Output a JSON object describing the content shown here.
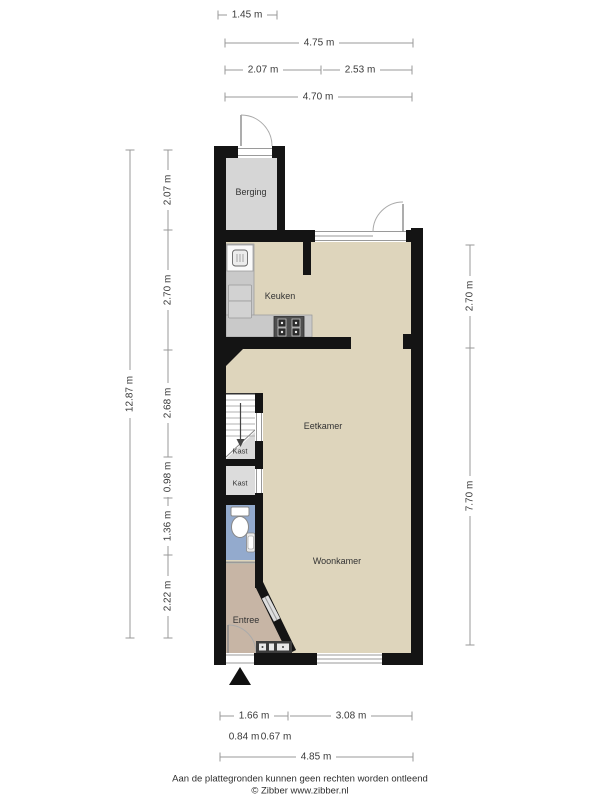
{
  "rooms": {
    "berging": "Berging",
    "keuken": "Keuken",
    "eetkamer": "Eetkamer",
    "kast_understairs": "Kast",
    "kast": "Kast",
    "woonkamer": "Woonkamer",
    "entree": "Entree"
  },
  "dimensions": {
    "top": [
      "1.45 m",
      "4.75 m",
      "2.07 m",
      "2.53 m",
      "4.70 m"
    ],
    "left_total": "12.87 m",
    "left_segments": [
      "2.07 m",
      "2.70 m",
      "2.68 m",
      "0.98 m",
      "1.36 m",
      "2.22 m"
    ],
    "right": [
      "2.70 m",
      "7.70 m"
    ],
    "bottom_row1": [
      "1.66 m",
      "3.08 m"
    ],
    "bottom_row2": [
      "0.84 m",
      "0.67 m"
    ],
    "bottom_total": "4.85 m"
  },
  "footer": {
    "disclaimer": "Aan de plattegronden kunnen geen rechten worden ontleend",
    "credit": "© Zibber www.zibber.nl"
  },
  "colors": {
    "wall": "#141414",
    "floor_main": "#ded5bc",
    "floor_berging": "#d6d6d6",
    "floor_kast": "#dcdcdc",
    "floor_toilet": "#93aacd",
    "floor_entree": "#c7b5a5",
    "counter": "#c9c9c9",
    "stove": "#4f4f4f",
    "dimension_line": "#999999",
    "label_text": "#333333"
  },
  "icons": {
    "entrance_marker": "filled-triangle-up",
    "stairs_arrow": "arrow-down",
    "appliance": "washing-machine-glyph",
    "stove": "four-burner-cooktop",
    "toilet": "toilet-with-tank",
    "hand_basin": "small-sink",
    "meter_box": "utility-meter-strip",
    "door_swing": "quarter-arc"
  }
}
